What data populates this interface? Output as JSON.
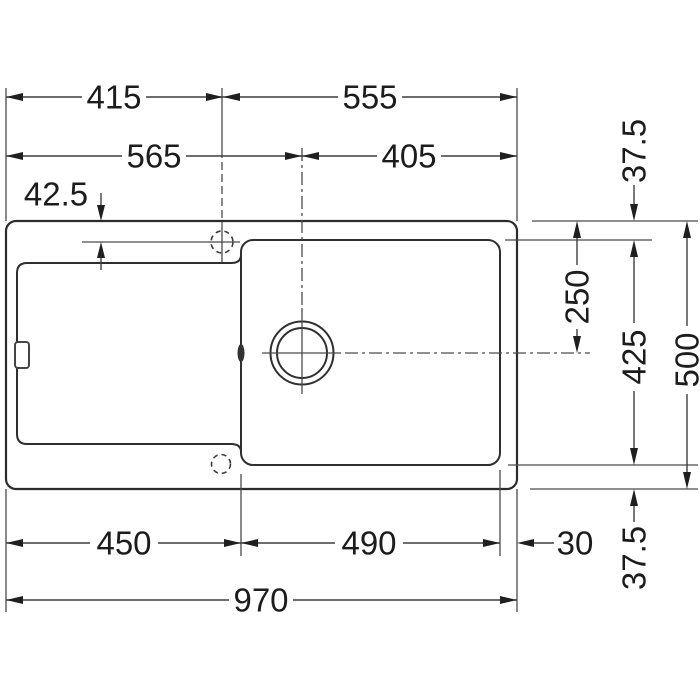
{
  "colors": {
    "background": "#ffffff",
    "line": "#2b2b2b",
    "text": "#1c1c1c"
  },
  "drawing": {
    "dims": {
      "top_left_width": "415",
      "top_right_width": "555",
      "center_left_width": "565",
      "center_right_width": "405",
      "tap_hole_offset": "42.5",
      "rim_top": "37.5",
      "center_depth": "250",
      "bowl_depth": "425",
      "overall_depth": "500",
      "rim_bottom": "37.5",
      "bottom_left_width": "450",
      "bowl_width": "490",
      "rim_right": "30",
      "overall_width": "970"
    }
  }
}
